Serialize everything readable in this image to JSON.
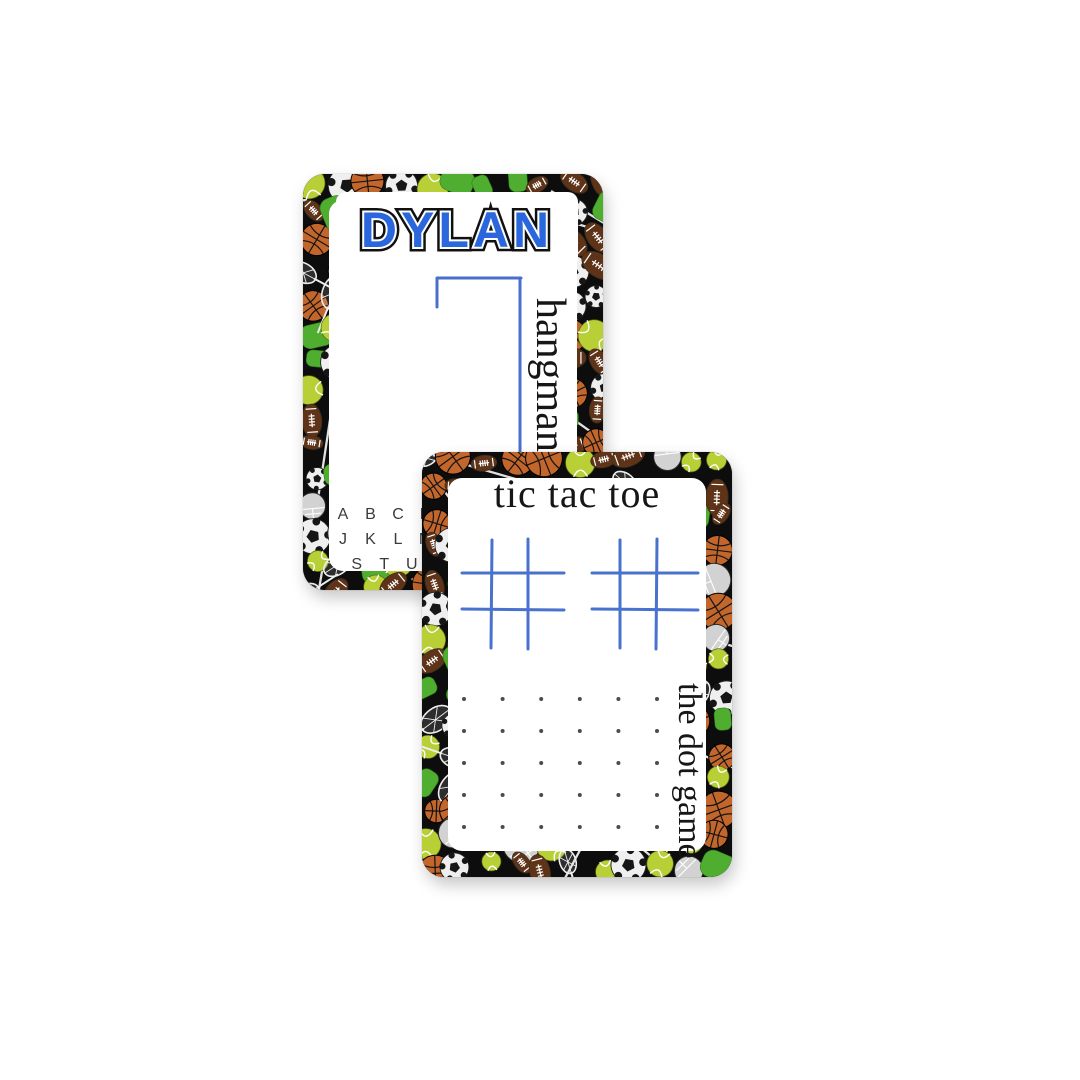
{
  "scene": {
    "background": "#ffffff"
  },
  "colors": {
    "card_border_black": "#0d0d0d",
    "panel_white": "#ffffff",
    "name_blue": "#2a66dc",
    "ink_blue": "#3a63c9",
    "grid_blue": "#2f5fc8",
    "dot_gray": "#4c4c4c",
    "text_black": "#161616",
    "alphabet_gray": "#3b3b3b",
    "basketball_orange": "#c2662b",
    "football_brown": "#5e3318",
    "football_tan": "#8a5a33",
    "tennis_green": "#b9cf36",
    "soccer_white": "#efefef",
    "accent_green": "#4fae2f",
    "helmet_gray": "#d2d2d2",
    "pattern_line_white": "#ededed"
  },
  "back_card": {
    "title": "DYLAN",
    "side_label": "hangman",
    "alphabet_rows": [
      [
        "A",
        "B",
        "C",
        "D",
        "E",
        "F",
        "G",
        "H",
        "I"
      ],
      [
        "J",
        "K",
        "L",
        "M",
        "N",
        "O",
        "P",
        "Q",
        "R"
      ],
      [
        "S",
        "T",
        "U",
        "V",
        "W",
        "X",
        "Y",
        "Z"
      ]
    ]
  },
  "front_card": {
    "title": "tic tac toe",
    "side_label": "the dot game",
    "tic_tac_toe_grid_count": 2,
    "dot_grid": {
      "rows": 5,
      "cols": 6
    }
  },
  "pattern_icons": [
    "basketball-icon",
    "football-icon",
    "tennis-ball-icon",
    "soccer-ball-icon",
    "lacrosse-stick-icon",
    "football-helmet-icon",
    "green-blob-icon"
  ]
}
